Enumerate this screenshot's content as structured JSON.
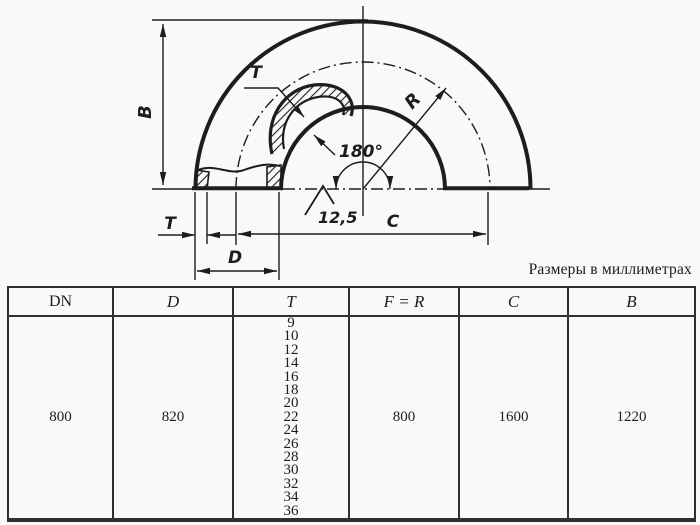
{
  "note": "Размеры в миллиметрах",
  "drawing": {
    "labels": {
      "b": "B",
      "t_section": "T",
      "t_wall": "T",
      "d": "D",
      "c": "C",
      "r": "R",
      "angle": "180°",
      "roughness": "12,5"
    }
  },
  "table": {
    "headers": [
      "DN",
      "D",
      "T",
      "F = R",
      "C",
      "B"
    ],
    "row": {
      "dn": "800",
      "d": "820",
      "t_values": [
        "9",
        "10",
        "12",
        "14",
        "16",
        "18",
        "20",
        "22",
        "24",
        "26",
        "28",
        "30",
        "32",
        "34",
        "36"
      ],
      "f_r": "800",
      "c": "1600",
      "b": "1220"
    }
  },
  "colors": {
    "ink": "#1d1d1d",
    "paper": "#f9f9f8",
    "table_border": "#2f2f2f"
  }
}
